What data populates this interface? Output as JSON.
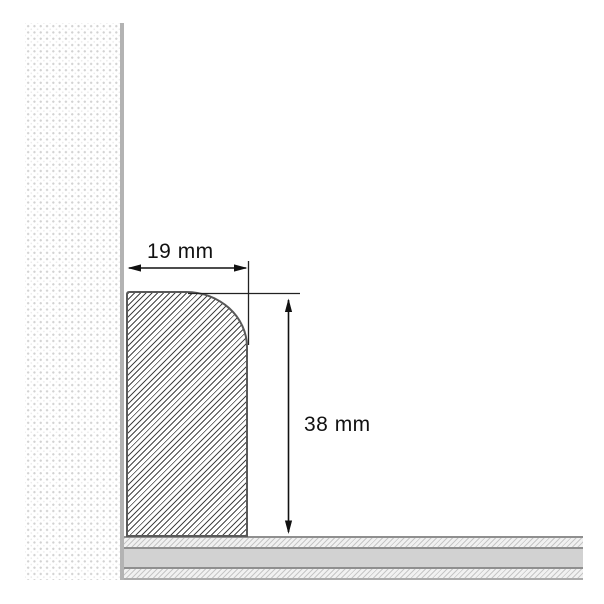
{
  "diagram": {
    "kind": "skirting-board-cross-section",
    "dimensions": {
      "width": {
        "label": "19 mm",
        "value": 19,
        "unit": "mm"
      },
      "height": {
        "label": "38 mm",
        "value": 38,
        "unit": "mm"
      }
    },
    "parts": {
      "wall": "wall-section",
      "board": "skirting-board-profile",
      "floor": "floor-section"
    },
    "colors": {
      "background": "#ffffff",
      "dimension_line": "#111111",
      "board_outline": "#595959",
      "wall_surface_line": "#b3b3b3",
      "floor_band_gray": "#d2d2d2",
      "floor_separator": "#8f8f8f"
    }
  }
}
